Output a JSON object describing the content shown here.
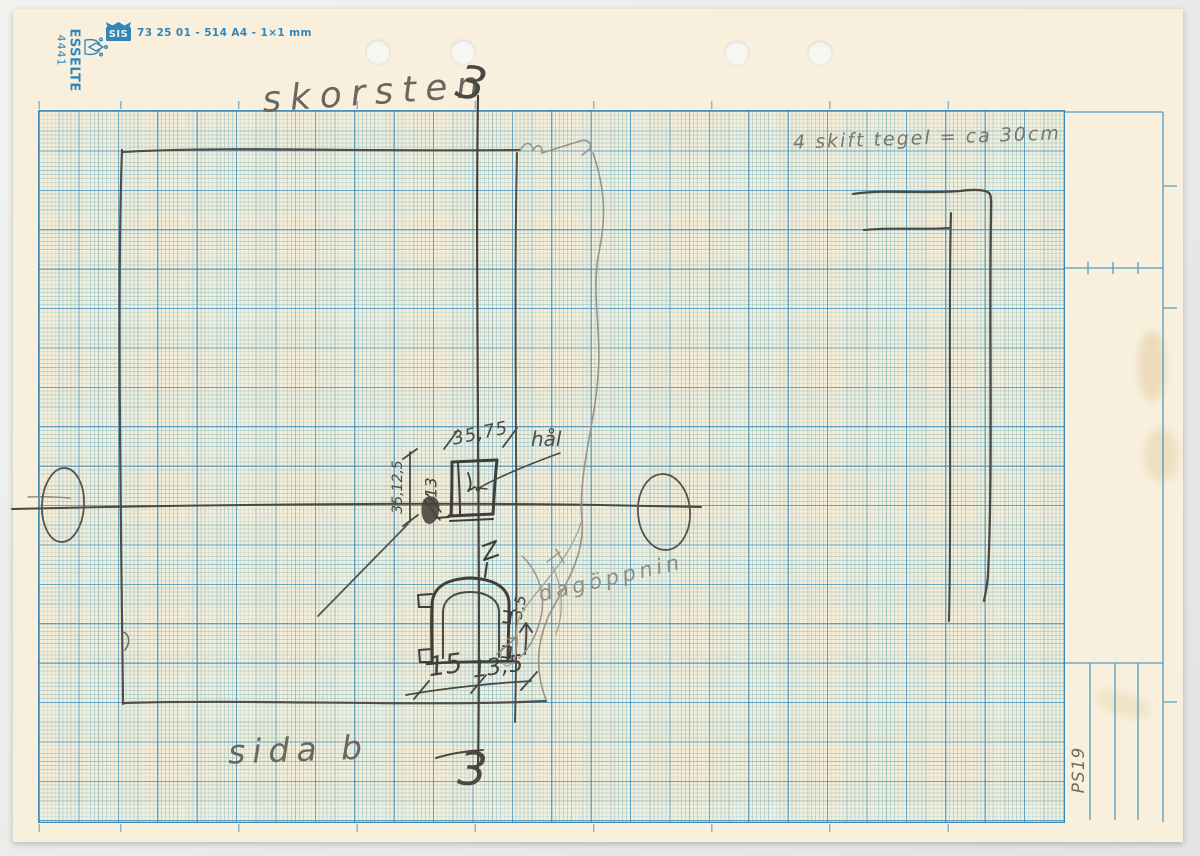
{
  "colors": {
    "background": "#edeeec",
    "paper": "#f8f0dd",
    "grid_line_major": "#2f86ba",
    "grid_tint": "#f2eeda",
    "pencil": "#454340",
    "print_blue": "#2f86ba"
  },
  "header": {
    "brand_number": "4441",
    "brand_name": "ESSELTE",
    "sis_label": "SIS",
    "product_code": "73 25 01 - 514 A4 - 1×1 mm"
  },
  "sketch": {
    "title": "skorsten",
    "section_marker_top": "3",
    "section_marker_bottom": "3",
    "note_top_right": "4 skift tegel = ca 30cm",
    "dim_above_flue": "35,75",
    "dim_left_of_flue": "35,12,5",
    "dim_left_scribble": "13",
    "hole_label": "hål",
    "opening_label": "dagöppnin",
    "opening_dim": "3,5",
    "dim_opening_width": "15",
    "dim_opening_width2": "13,5",
    "side_label": "sida b"
  },
  "footer": {
    "page_ref": "PS19"
  }
}
